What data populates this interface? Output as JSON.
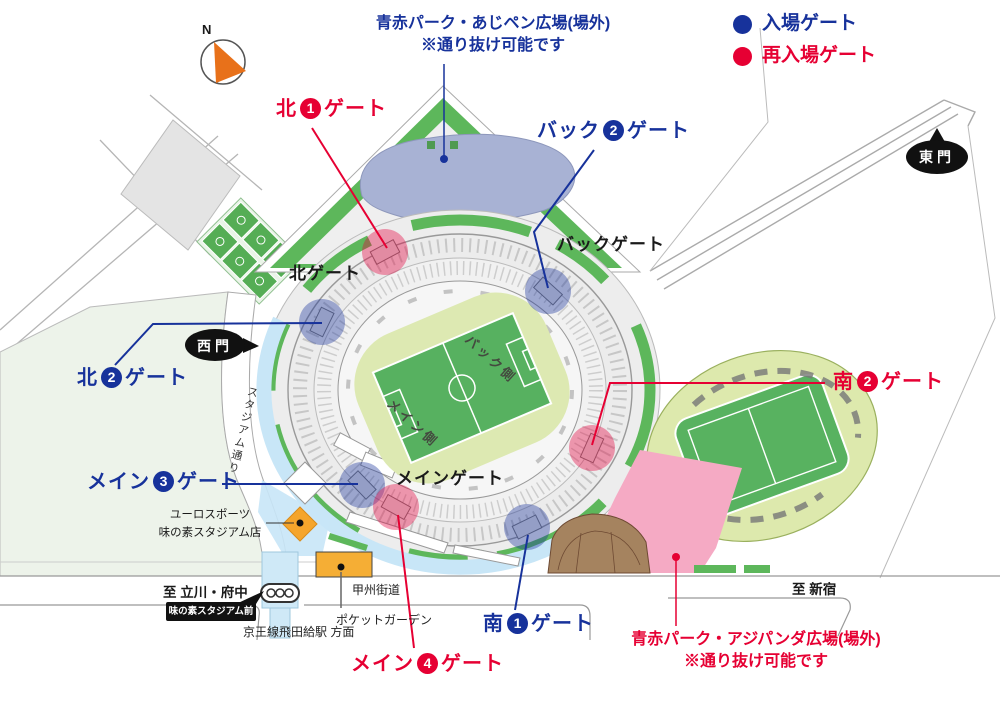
{
  "legend": {
    "entry": {
      "label": "入場ゲート",
      "color": "#17329b"
    },
    "reentry": {
      "label": "再入場ゲート",
      "color": "#e60033"
    }
  },
  "notes": {
    "top": {
      "line1": "青赤パーク・あじペン広場(場外)",
      "line2": "※通り抜け可能です",
      "color": "#17329b"
    },
    "bottom": {
      "line1": "青赤パーク・アジパンダ広場(場外)",
      "line2": "※通り抜け可能です",
      "color": "#e60033"
    }
  },
  "gates": [
    {
      "prefix": "北",
      "num": "1",
      "suffix": "ゲート",
      "type": "reentry"
    },
    {
      "prefix": "バック",
      "num": "2",
      "suffix": "ゲート",
      "type": "entry"
    },
    {
      "prefix": "北",
      "num": "2",
      "suffix": "ゲート",
      "type": "entry"
    },
    {
      "prefix": "南",
      "num": "2",
      "suffix": "ゲート",
      "type": "reentry"
    },
    {
      "prefix": "メイン",
      "num": "3",
      "suffix": "ゲート",
      "type": "entry"
    },
    {
      "prefix": "メイン",
      "num": "4",
      "suffix": "ゲート",
      "type": "reentry"
    },
    {
      "prefix": "南",
      "num": "1",
      "suffix": "ゲート",
      "type": "entry"
    }
  ],
  "stadium": {
    "north_gate": "北ゲート",
    "back_gate": "バックゲート",
    "main_gate": "メインゲート",
    "back_side": "バック側",
    "main_side": "メイン側"
  },
  "places": {
    "stadium_street": "スタジアム通り",
    "shop_line1": "ユーロスポーツ",
    "shop_line2": "味の素スタジアム店",
    "koshu_kaido": "甲州街道",
    "pocket_garden": "ポケットガーデン",
    "keio_station": "京王線飛田給駅 方面",
    "to_tachikawa": "至 立川・府中",
    "to_shinjuku": "至 新宿",
    "bus_stop": "味の素スタジアム前",
    "east_gate": "東門",
    "west_gate": "西門"
  },
  "compass": {
    "north": "N"
  },
  "colors": {
    "entry_blue": "#17329b",
    "reentry_red": "#e60033",
    "map_green": "#5db75b",
    "pitch_green": "#57b160",
    "infield_green": "#dde9b2",
    "pond_blue": "#a8b2d4",
    "walkway_blue": "#c8e6f7",
    "plaza_pink": "#f5aac4",
    "amphitheater_brown": "#a5835f",
    "store_orange": "#f5a52c"
  }
}
